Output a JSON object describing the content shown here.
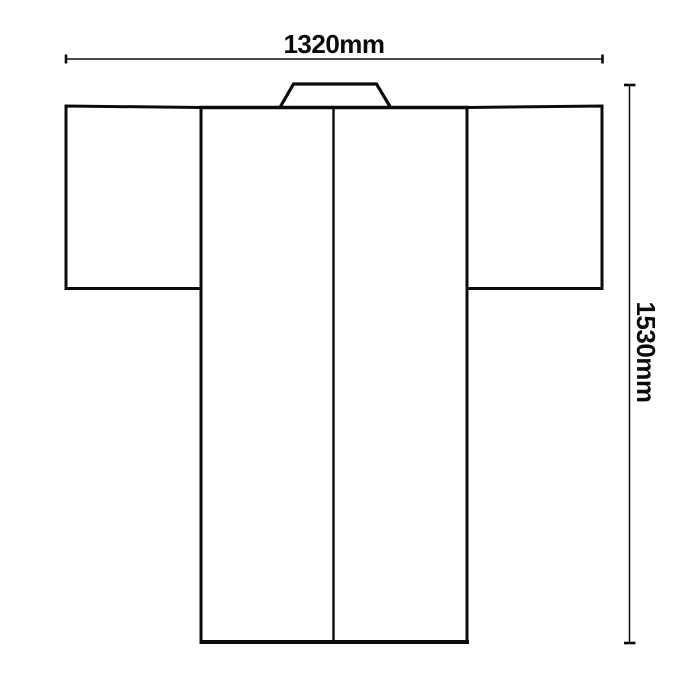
{
  "colors": {
    "line": "#0b0b0b",
    "background": "#ffffff"
  },
  "dimensions": {
    "width_label": "1320mm",
    "height_label": "1530mm"
  },
  "figure": {
    "name": "kimono-flat-outline-diagram"
  }
}
